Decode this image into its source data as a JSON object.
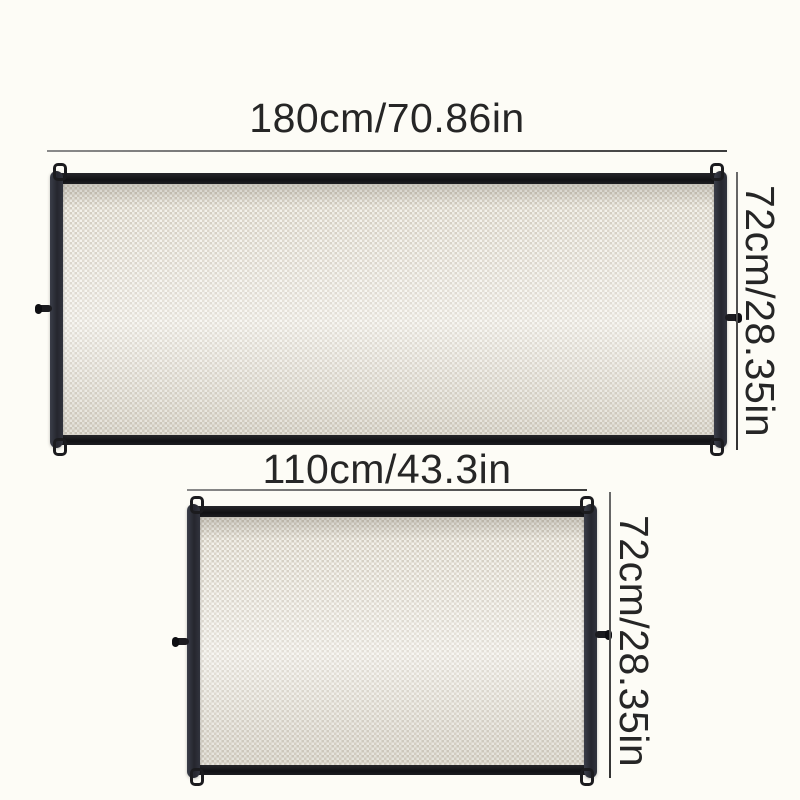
{
  "gates": [
    {
      "width_label": "180cm/70.86in",
      "height_label": "72cm/28.35in"
    },
    {
      "width_label": "110cm/43.3in",
      "height_label": "72cm/28.35in"
    }
  ],
  "colors": {
    "background": "#fdfcf6",
    "frame_bar": "#131316",
    "side_bar": "#2e3039",
    "mesh_base": "#efede6",
    "mesh_dot": "#d2ccc0",
    "dimension_line": "#4a4a4a",
    "label_text": "#262626"
  }
}
